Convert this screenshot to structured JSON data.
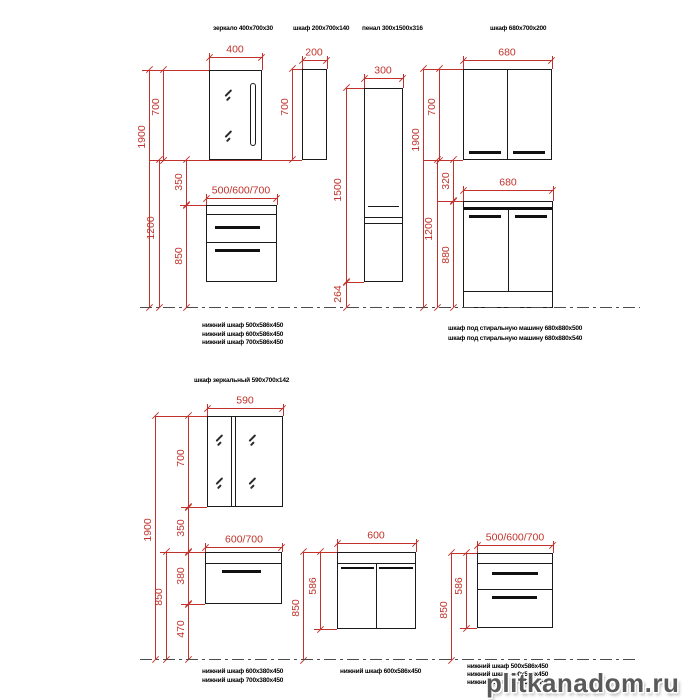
{
  "colors": {
    "dimension_red": "#c0322b",
    "line_black": "#1b1b1b",
    "watermark_gray": "#2a2a2a"
  },
  "top": {
    "product_labels": {
      "mirror": "зеркало 400x700x30",
      "cabinet200": "шкаф 200x700x140",
      "penal": "пенал 300x1500x316",
      "cabinet680": "шкаф 680x700x200"
    },
    "dims": {
      "mirror_width": "400",
      "mirror_height": "700",
      "total_height": "1900",
      "mirror_bottom_height": "1200",
      "gap_mirror_vanity": "350",
      "vanity_width": "500/600/700",
      "vanity_top_height": "850",
      "cabinet200_width": "200",
      "cabinet200_height": "700",
      "penal_width": "300",
      "penal_height": "1500",
      "penal_floor_gap": "264",
      "right_total_height": "1900",
      "upper_cabinet_width": "680",
      "upper_cabinet_height": "700",
      "gap_320": "320",
      "right_1200": "1200",
      "washer_cabinet_width": "680",
      "washer_cabinet_height": "880"
    },
    "captions_left": [
      "нижний шкаф  500x586x450",
      "нижний шкаф  600x586x450",
      "нижний шкаф  700x586x450"
    ],
    "captions_right": [
      "шкаф под стиральную машину 680x880x500",
      "шкаф под стиральную машину 680x880x540"
    ]
  },
  "bottom": {
    "title": "шкаф зеркальный 590x700x142",
    "dims": {
      "mirror_width": "590",
      "mirror_height": "700",
      "total_height": "1900",
      "gap_mirror_vanity": "350",
      "vanity1_width": "600/700",
      "vanity1_height": "380",
      "vanity1_floor_gap": "470",
      "vanity1_top_height": "850",
      "vanity2_width": "600",
      "vanity2_height": "586",
      "vanity2_top_height": "850",
      "vanity3_width": "500/600/700",
      "vanity3_height": "586",
      "vanity3_top_height": "850"
    },
    "captions_left": [
      "нижний шкаф  600x380x450",
      "нижний шкаф  700x380x450"
    ],
    "captions_mid": [
      "нижний шкаф  600x586x450"
    ],
    "captions_right": [
      "нижний шкаф  500x586x450",
      "нижний шкаф  600x586x450",
      "нижний шкаф  700x586x450"
    ]
  },
  "watermark": "plitkanadom.ru"
}
